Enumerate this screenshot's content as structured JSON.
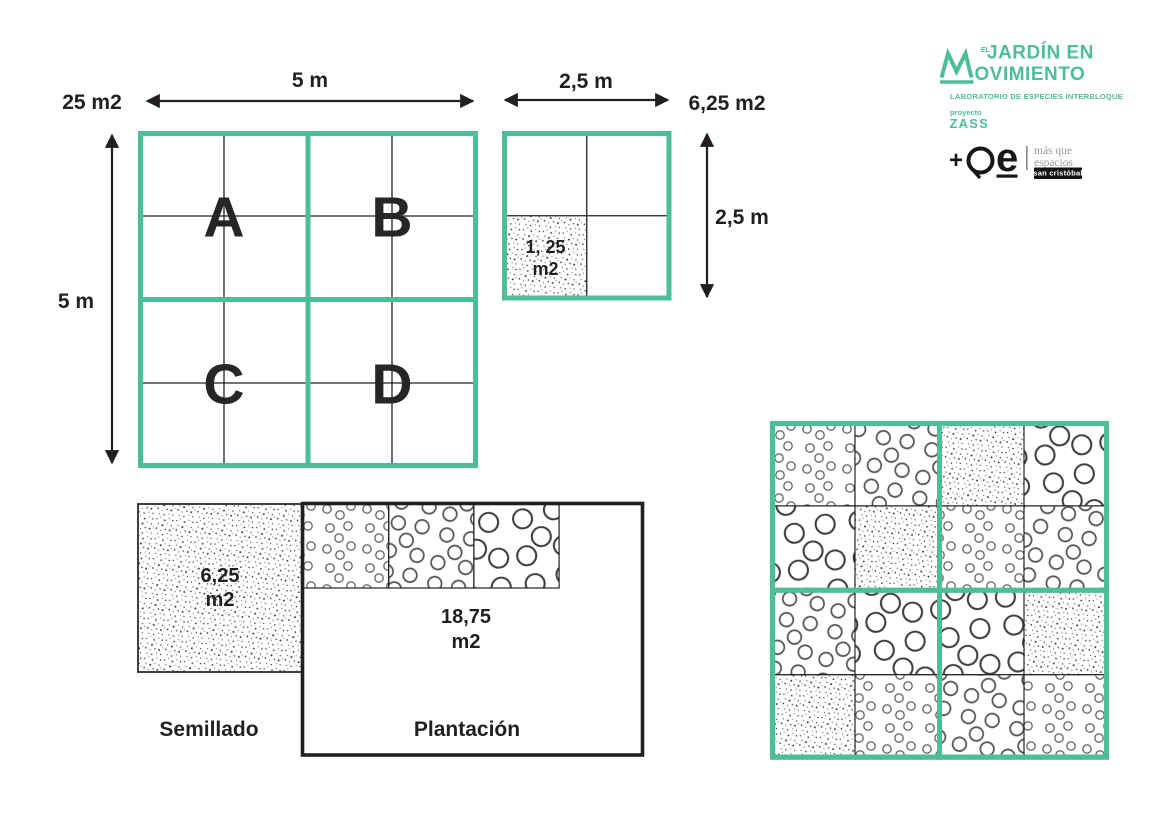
{
  "colors": {
    "teal": "#4dbe95",
    "ink": "#231f20",
    "circle_stroke_small": "#6e6e6e",
    "circle_stroke_medium": "#595959",
    "circle_stroke_large": "#3f3f3f",
    "logo_gray": "#9a9a9a",
    "badge_bg": "#111111",
    "badge_text": "#ffffff"
  },
  "big_square": {
    "area_label": "25 m2",
    "width_label": "5 m",
    "height_label": "5 m",
    "quadrants": [
      "A",
      "B",
      "C",
      "D"
    ]
  },
  "small_square": {
    "area_label": "6,25 m2",
    "width_label": "2,5 m",
    "height_label": "2,5 m",
    "cell_line1": "1, 25",
    "cell_line2": "m2"
  },
  "bottom_diagram": {
    "seed_area_line1": "6,25",
    "seed_area_line2": "m2",
    "plant_area_line1": "18,75",
    "plant_area_line2": "m2",
    "seed_caption": "Semillado",
    "plant_caption": "Plantación",
    "strip_patterns": [
      "circles-sm",
      "circles-md",
      "circles-lg"
    ]
  },
  "pattern_grid": {
    "rows": [
      [
        "circles-sm",
        "circles-md",
        "stipple",
        "circles-lg"
      ],
      [
        "circles-lg",
        "stipple",
        "circles-sm",
        "circles-md"
      ],
      [
        "circles-md",
        "circles-lg",
        "circles-lg",
        "stipple"
      ],
      [
        "stipple",
        "circles-sm",
        "circles-md",
        "circles-sm"
      ]
    ]
  },
  "logo": {
    "el": "EL",
    "line1": "JARDÍN EN",
    "line2": "OVIMIENTO",
    "tagline": "LABORATORIO DE ESPECIES INTERBLOQUE",
    "project_label": "proyecto",
    "project_name": "ZASS",
    "plus": "+",
    "e": "e",
    "partner_line1": "más que",
    "partner_line2": "espacios",
    "partner_badge": "san cristóbal"
  }
}
